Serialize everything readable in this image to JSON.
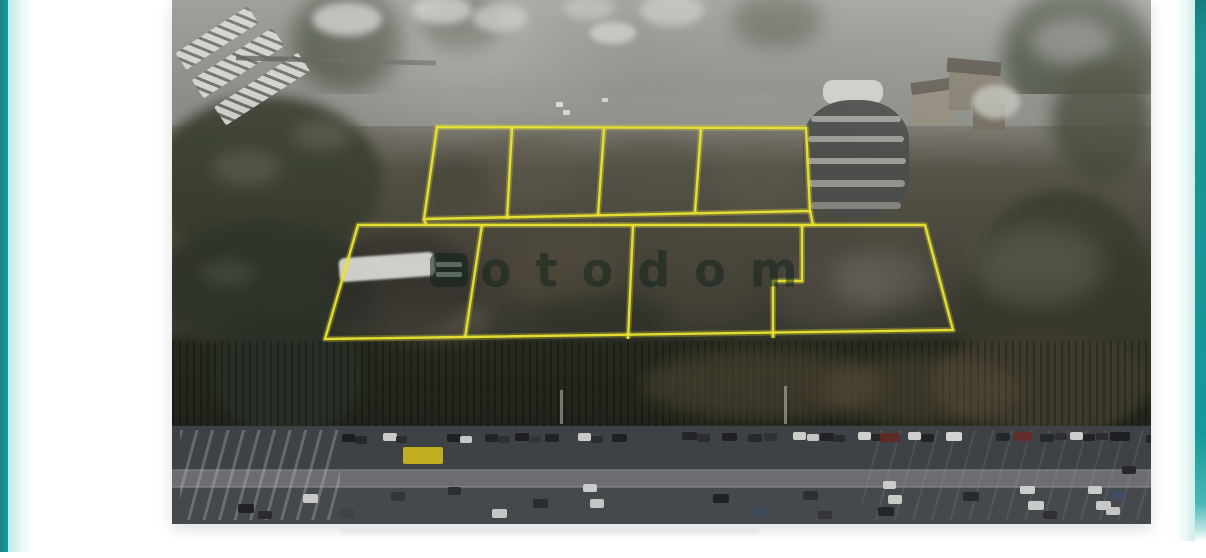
{
  "palette": {
    "accent_teal": "#13999b",
    "plot_outline_yellow": "#e9e431",
    "page_background": "#ffffff"
  },
  "photo": {
    "watermark": {
      "text": "otodom",
      "logo": "otodom-grid-logo",
      "color": "rgba(14,34,26,0.5)"
    },
    "plots": {
      "upper_outline": [
        [
          265,
          127
        ],
        [
          634,
          128
        ],
        [
          638,
          211
        ],
        [
          252,
          219
        ]
      ],
      "upper_dividers": [
        [
          [
            340,
            128
          ],
          [
            335,
            219
          ]
        ],
        [
          [
            432,
            129
          ],
          [
            426,
            216
          ]
        ],
        [
          [
            529,
            129
          ],
          [
            523,
            212
          ]
        ]
      ],
      "upper_stubs": [
        [
          [
            638,
            211
          ],
          [
            641,
            225
          ]
        ],
        [
          [
            252,
            219
          ],
          [
            254,
            225
          ]
        ]
      ],
      "lower_outline": [
        [
          186,
          225
        ],
        [
          753,
          225
        ],
        [
          781,
          330
        ],
        [
          153,
          339
        ]
      ],
      "lower_dividers": [
        [
          [
            310,
            225
          ],
          [
            293,
            338
          ]
        ],
        [
          [
            461,
            226
          ],
          [
            456,
            339
          ]
        ]
      ],
      "lower_step": [
        [
          630,
          225
        ],
        [
          630,
          281
        ],
        [
          601,
          281
        ],
        [
          601,
          338
        ]
      ]
    },
    "cars": [
      {
        "x": 170,
        "y": 434,
        "w": 13,
        "h": 8,
        "c": "#1b1d20"
      },
      {
        "x": 183,
        "y": 436,
        "w": 12,
        "h": 8,
        "c": "#26282c"
      },
      {
        "x": 211,
        "y": 433,
        "w": 14,
        "h": 8,
        "c": "#c9cbc8"
      },
      {
        "x": 224,
        "y": 436,
        "w": 11,
        "h": 7,
        "c": "#2a2c30"
      },
      {
        "x": 231,
        "y": 447,
        "w": 40,
        "h": 17,
        "c": "#c0ae20"
      },
      {
        "x": 275,
        "y": 434,
        "w": 14,
        "h": 8,
        "c": "#1e2023"
      },
      {
        "x": 288,
        "y": 436,
        "w": 12,
        "h": 7,
        "c": "#c6c8c5"
      },
      {
        "x": 313,
        "y": 434,
        "w": 13,
        "h": 8,
        "c": "#222428"
      },
      {
        "x": 326,
        "y": 436,
        "w": 12,
        "h": 7,
        "c": "#2e3034"
      },
      {
        "x": 343,
        "y": 433,
        "w": 14,
        "h": 8,
        "c": "#1d1f23"
      },
      {
        "x": 357,
        "y": 436,
        "w": 12,
        "h": 7,
        "c": "#33353a"
      },
      {
        "x": 373,
        "y": 434,
        "w": 14,
        "h": 8,
        "c": "#212327"
      },
      {
        "x": 406,
        "y": 433,
        "w": 13,
        "h": 8,
        "c": "#c8cac7"
      },
      {
        "x": 419,
        "y": 436,
        "w": 12,
        "h": 7,
        "c": "#2b2d31"
      },
      {
        "x": 440,
        "y": 434,
        "w": 15,
        "h": 8,
        "c": "#1f2125"
      },
      {
        "x": 510,
        "y": 432,
        "w": 15,
        "h": 8,
        "c": "#232529"
      },
      {
        "x": 525,
        "y": 434,
        "w": 13,
        "h": 8,
        "c": "#2b2d32"
      },
      {
        "x": 550,
        "y": 433,
        "w": 15,
        "h": 8,
        "c": "#1e2024"
      },
      {
        "x": 576,
        "y": 434,
        "w": 14,
        "h": 8,
        "c": "#26282d"
      },
      {
        "x": 592,
        "y": 433,
        "w": 13,
        "h": 8,
        "c": "#2f3136"
      },
      {
        "x": 621,
        "y": 432,
        "w": 13,
        "h": 8,
        "c": "#cbcdca"
      },
      {
        "x": 635,
        "y": 434,
        "w": 12,
        "h": 7,
        "c": "#c4c6c3"
      },
      {
        "x": 648,
        "y": 433,
        "w": 14,
        "h": 8,
        "c": "#212328"
      },
      {
        "x": 661,
        "y": 435,
        "w": 12,
        "h": 7,
        "c": "#282a2f"
      },
      {
        "x": 686,
        "y": 432,
        "w": 13,
        "h": 8,
        "c": "#cdcfcc"
      },
      {
        "x": 699,
        "y": 434,
        "w": 12,
        "h": 7,
        "c": "#25272b"
      },
      {
        "x": 708,
        "y": 433,
        "w": 20,
        "h": 9,
        "c": "#5d2a28"
      },
      {
        "x": 736,
        "y": 432,
        "w": 13,
        "h": 8,
        "c": "#ced0cd"
      },
      {
        "x": 749,
        "y": 434,
        "w": 13,
        "h": 8,
        "c": "#212327"
      },
      {
        "x": 774,
        "y": 432,
        "w": 16,
        "h": 9,
        "c": "#d2d4d1"
      },
      {
        "x": 824,
        "y": 433,
        "w": 14,
        "h": 8,
        "c": "#24262a"
      },
      {
        "x": 842,
        "y": 432,
        "w": 18,
        "h": 9,
        "c": "#622e2a"
      },
      {
        "x": 868,
        "y": 434,
        "w": 14,
        "h": 8,
        "c": "#26282c"
      },
      {
        "x": 883,
        "y": 433,
        "w": 12,
        "h": 7,
        "c": "#2e3035"
      },
      {
        "x": 898,
        "y": 432,
        "w": 13,
        "h": 8,
        "c": "#cccecb"
      },
      {
        "x": 911,
        "y": 434,
        "w": 12,
        "h": 7,
        "c": "#212327"
      },
      {
        "x": 924,
        "y": 433,
        "w": 12,
        "h": 7,
        "c": "#292b2f"
      },
      {
        "x": 938,
        "y": 432,
        "w": 20,
        "h": 9,
        "c": "#1d1f24"
      },
      {
        "x": 974,
        "y": 435,
        "w": 14,
        "h": 8,
        "c": "#24262b"
      },
      {
        "x": 950,
        "y": 466,
        "w": 14,
        "h": 8,
        "c": "#26282d"
      },
      {
        "x": 66,
        "y": 504,
        "w": 16,
        "h": 9,
        "c": "#1f2124"
      },
      {
        "x": 86,
        "y": 511,
        "w": 14,
        "h": 8,
        "c": "#2a2c2f"
      },
      {
        "x": 131,
        "y": 494,
        "w": 15,
        "h": 9,
        "c": "#c8cac7"
      },
      {
        "x": 168,
        "y": 509,
        "w": 15,
        "h": 9,
        "c": "#3f4246"
      },
      {
        "x": 219,
        "y": 492,
        "w": 14,
        "h": 9,
        "c": "#323539"
      },
      {
        "x": 276,
        "y": 487,
        "w": 13,
        "h": 8,
        "c": "#2b2d31"
      },
      {
        "x": 320,
        "y": 509,
        "w": 15,
        "h": 9,
        "c": "#c5c7c4"
      },
      {
        "x": 361,
        "y": 499,
        "w": 15,
        "h": 9,
        "c": "#2a2c30"
      },
      {
        "x": 411,
        "y": 484,
        "w": 14,
        "h": 8,
        "c": "#cacccb"
      },
      {
        "x": 418,
        "y": 499,
        "w": 14,
        "h": 9,
        "c": "#c3c5c2"
      },
      {
        "x": 541,
        "y": 494,
        "w": 16,
        "h": 9,
        "c": "#202226"
      },
      {
        "x": 581,
        "y": 507,
        "w": 15,
        "h": 9,
        "c": "#3c4a5c"
      },
      {
        "x": 631,
        "y": 491,
        "w": 15,
        "h": 9,
        "c": "#2d2f33"
      },
      {
        "x": 646,
        "y": 511,
        "w": 14,
        "h": 8,
        "c": "#333539"
      },
      {
        "x": 706,
        "y": 507,
        "w": 16,
        "h": 9,
        "c": "#24262a"
      },
      {
        "x": 711,
        "y": 481,
        "w": 13,
        "h": 8,
        "c": "#cbcdc9"
      },
      {
        "x": 716,
        "y": 495,
        "w": 14,
        "h": 9,
        "c": "#c8cac6"
      },
      {
        "x": 791,
        "y": 492,
        "w": 16,
        "h": 9,
        "c": "#282a2e"
      },
      {
        "x": 848,
        "y": 486,
        "w": 15,
        "h": 8,
        "c": "#cccecb"
      },
      {
        "x": 856,
        "y": 501,
        "w": 16,
        "h": 9,
        "c": "#c8cac7"
      },
      {
        "x": 871,
        "y": 511,
        "w": 14,
        "h": 8,
        "c": "#2f3135"
      },
      {
        "x": 916,
        "y": 486,
        "w": 14,
        "h": 8,
        "c": "#cacccb"
      },
      {
        "x": 924,
        "y": 501,
        "w": 15,
        "h": 9,
        "c": "#c7c9c6"
      },
      {
        "x": 940,
        "y": 491,
        "w": 13,
        "h": 8,
        "c": "#3f4e66"
      },
      {
        "x": 934,
        "y": 507,
        "w": 14,
        "h": 8,
        "c": "#c4c6c3"
      }
    ]
  }
}
